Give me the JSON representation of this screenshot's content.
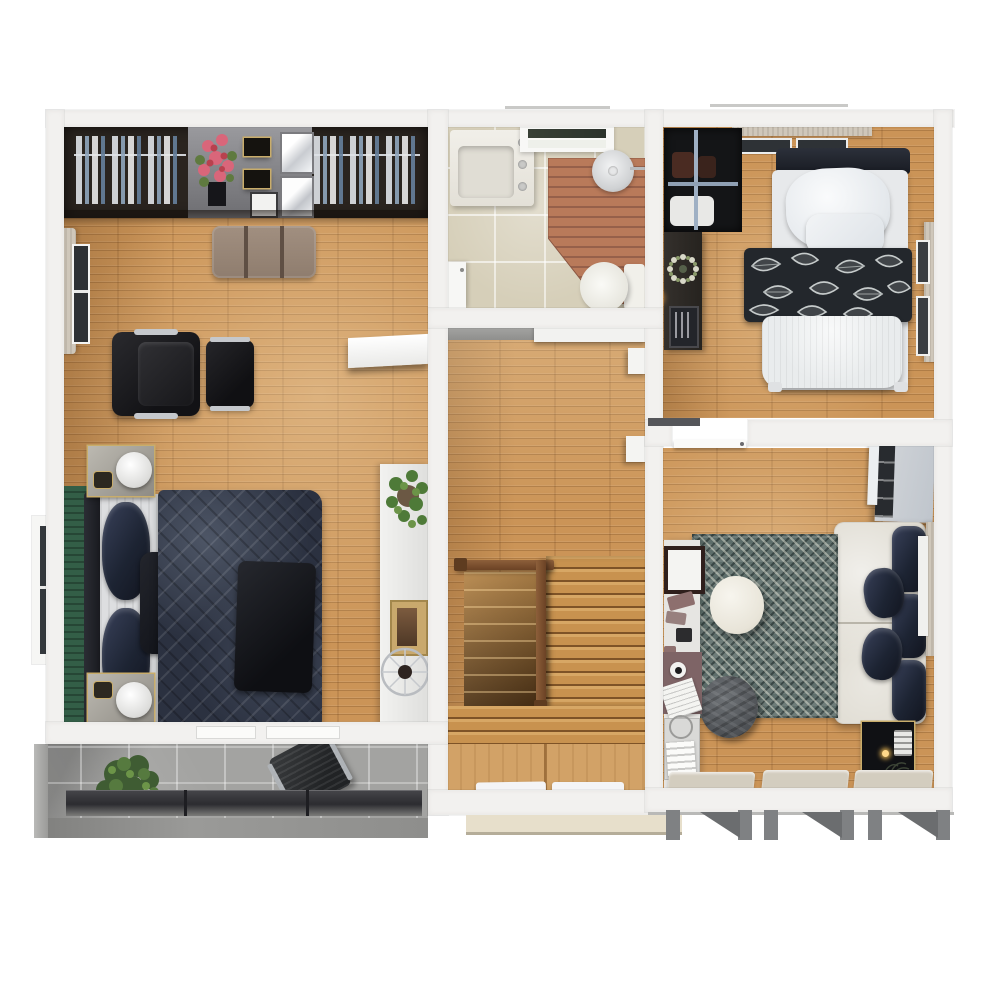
{
  "scene": {
    "kind": "3d-rendered-floor-plan-top-view",
    "floor_label": "upper floor with staircase and balcony",
    "rooms": [
      {
        "name": "master-bedroom",
        "position": "top-left",
        "furniture": [
          "wardrobe-closet-with-hanging-clothes",
          "vanity-island-with-flower-bouquet",
          "mirror-panels",
          "upholstered-bench",
          "black-leather-armchair",
          "black-leather-ottoman",
          "wall-shelf",
          "double-bed-navy-quilt",
          "nightstand-with-lamp-top",
          "nightstand-with-lamp-bottom",
          "green-area-rug",
          "white-console-table",
          "potted-plant",
          "decorative-wheel",
          "window-with-curtain-upper",
          "window-lower"
        ]
      },
      {
        "name": "bathroom",
        "position": "top-center",
        "furniture": [
          "sink-vanity",
          "window",
          "wooden-shower-deck",
          "round-shower-head",
          "toilet",
          "door"
        ]
      },
      {
        "name": "bedroom",
        "position": "top-right",
        "furniture": [
          "open-wardrobe-with-rail",
          "dark-desk",
          "wreath-decor",
          "picture-frame",
          "single-bed",
          "white-pillows",
          "leaf-pattern-blanket",
          "white-duvet",
          "top-window-curtain",
          "right-window-curtain"
        ]
      },
      {
        "name": "hallway-staircase",
        "position": "center",
        "furniture": [
          "upper-landing",
          "wood-railing",
          "stairwell-opening",
          "stair-treads",
          "landing-planks",
          "doormat-left",
          "doormat-right",
          "exterior-step"
        ]
      },
      {
        "name": "living-room",
        "position": "bottom-right",
        "furniture": [
          "white-cabinet",
          "cream-sofa",
          "navy-back-cushions",
          "navy-throw-pillows",
          "teal-patterned-rug",
          "egg-ottoman",
          "gray-pouf",
          "white-desk",
          "picture-frame",
          "notebooks",
          "desk-pad-with-cup",
          "magazines",
          "book-trolley",
          "black-gold-side-table",
          "window-mats-bottom",
          "open-door",
          "awning-brackets"
        ]
      },
      {
        "name": "balcony",
        "position": "bottom-left",
        "furniture": [
          "green-plant",
          "metal-chair",
          "dark-planter-box"
        ]
      }
    ]
  },
  "colors": {
    "wall": "#f2f1ef",
    "wood": "#cb9457",
    "bathFloor": "#d6cfb9",
    "balcony": "#a3a3a1",
    "closetDark": "#2a241f",
    "navy": "#2b3140",
    "navyDeep": "#191b20",
    "cream": "#dbd7cc",
    "cushionNavy": "#232a3a",
    "rugTeal": "#5d6d6a",
    "greenRug": "#335e47",
    "terracotta": "#b97a5a",
    "railBrown": "#7c4f2e",
    "curtainBeige": "#cfc7ba",
    "gold": "#c9ad6b",
    "planterDark": "#3a3a3e"
  }
}
